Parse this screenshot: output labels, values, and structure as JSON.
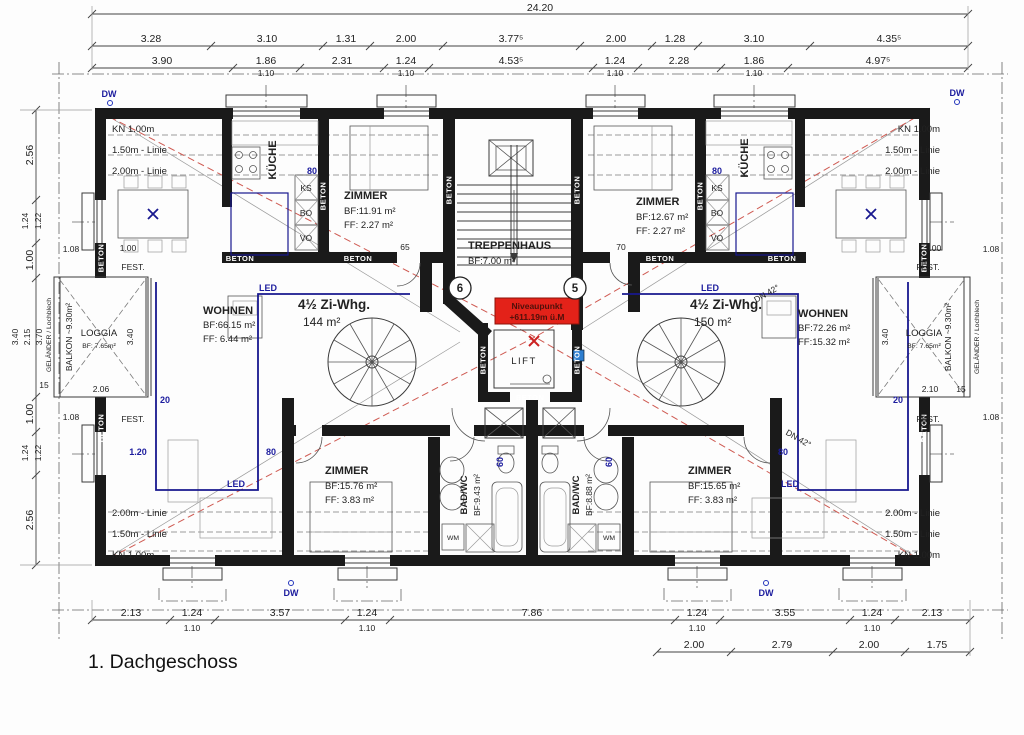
{
  "title": "1. Dachgeschoss",
  "dims": {
    "total": "24.20",
    "top2": [
      "3.28",
      "3.10",
      "1.31",
      "2.00",
      "3.77⁵",
      "2.00",
      "1.28",
      "3.10",
      "4.35⁵"
    ],
    "top3": [
      "3.90",
      "1.86",
      "2.31",
      "1.24",
      "4.53⁵",
      "1.24",
      "2.28",
      "1.86",
      "4.97⁵"
    ],
    "axis": "1.10",
    "left": [
      "2.56",
      "1.24",
      "1.22",
      "1.00",
      "3.40",
      "2.15",
      "3.70",
      "1.00",
      "1.24",
      "1.22",
      "2.56"
    ],
    "bot1": [
      "2.13",
      "1.24",
      "3.57",
      "1.24",
      "7.86",
      "1.24",
      "3.55",
      "1.24",
      "2.13"
    ],
    "bot2": [
      "2.00",
      "2.79",
      "2.00",
      "1.75"
    ],
    "door_left": "65",
    "door_right": "70",
    "sill": [
      "1.08",
      "1.00",
      "2.06",
      "2.10",
      "15"
    ],
    "knee": {
      "kn": "KN 1.00m",
      "l150": "1.50m - Linie",
      "l200": "2.00m - Linie"
    },
    "blue": {
      "b20": "20",
      "b80": "80",
      "b120": "1.20",
      "b60": "60",
      "led": "LED"
    },
    "dw": "DW",
    "dn": "DN 42°"
  },
  "flats": {
    "left": {
      "name": "4½ Zi-Whg.",
      "area": "144 m²",
      "kueche": "KÜCHE",
      "zimmer_top": {
        "n": "ZIMMER",
        "bf": "BF:11.91 m²",
        "ff": "FF: 2.27 m²"
      },
      "wohnen": {
        "n": "WOHNEN",
        "bf": "BF:66.15 m²",
        "ff": "FF: 6.44 m²"
      },
      "zimmer_bot": {
        "n": "ZIMMER",
        "bf": "BF:15.76 m²",
        "ff": "FF: 3.83 m²"
      },
      "bad": {
        "n": "BAD/WC",
        "bf": "BF:9.43 m²"
      }
    },
    "right": {
      "name": "4½ Zi-Whg.",
      "area": "150 m²",
      "kueche": "KÜCHE",
      "zimmer_top": {
        "n": "ZIMMER",
        "bf": "BF:12.67 m²",
        "ff": "FF: 2.27 m²"
      },
      "wohnen": {
        "n": "WOHNEN",
        "bf": "BF:72.26 m²",
        "ff": "FF:15.32 m²"
      },
      "zimmer_bot": {
        "n": "ZIMMER",
        "bf": "BF:15.65 m²",
        "ff": "FF: 3.83 m²"
      },
      "bad": {
        "n": "BAD/WC",
        "bf": "BF:8.88 m²"
      }
    }
  },
  "core": {
    "treppenhaus": {
      "n": "TREPPENHAUS",
      "bf": "BF:7.00 m²"
    },
    "lift": "LIFT",
    "niveau": {
      "l1": "Niveaupunkt",
      "l2": "+611.19m ü.M"
    },
    "axis_left": "6",
    "axis_right": "5"
  },
  "balcony": {
    "loggia": "LOGGIA",
    "bf": "BF: 7.65m²",
    "balkon": "BALKON ~9.30m²",
    "gelaender": "GELÄNDER / Lochblech",
    "dim34": "3.40"
  },
  "labels": {
    "beton": "BETON",
    "fest": "FEST.",
    "ks": "KS",
    "bo": "BO",
    "vo": "VO",
    "wm": "WM"
  }
}
